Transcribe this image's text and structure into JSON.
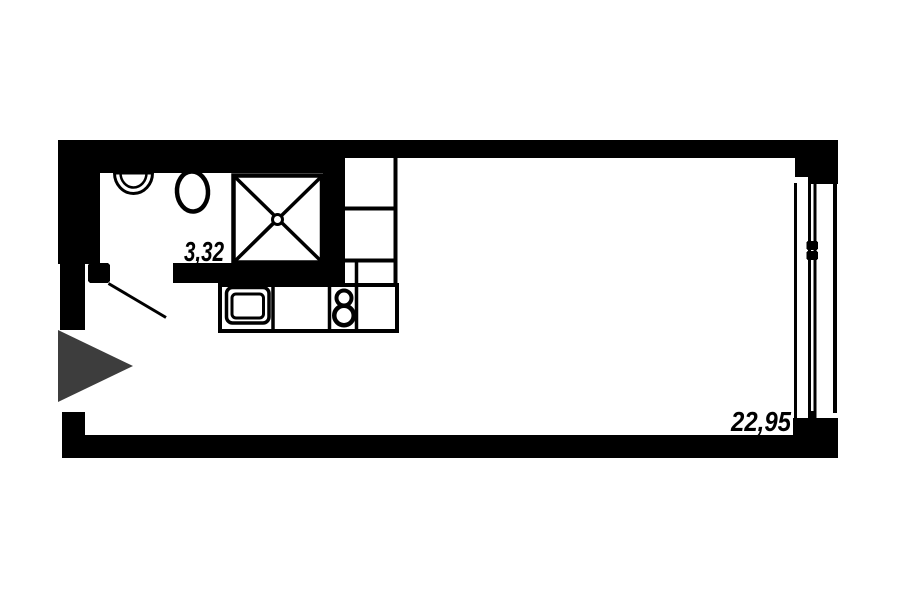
{
  "floorplan": {
    "colors": {
      "background": "#ffffff",
      "walls": "#000000",
      "fixture_fill": "#ffffff",
      "entrance_arrow": "#3d3d3d"
    },
    "rooms": [
      {
        "name": "bathroom",
        "area": "3,32"
      },
      {
        "name": "main-room",
        "area": "22,95"
      }
    ],
    "fixtures": [
      "wash-basin",
      "toilet",
      "shower-cabin",
      "kitchen-cabinets",
      "kitchen-sink",
      "stove-2-burner",
      "window",
      "door-swing",
      "entrance-arrow"
    ]
  }
}
